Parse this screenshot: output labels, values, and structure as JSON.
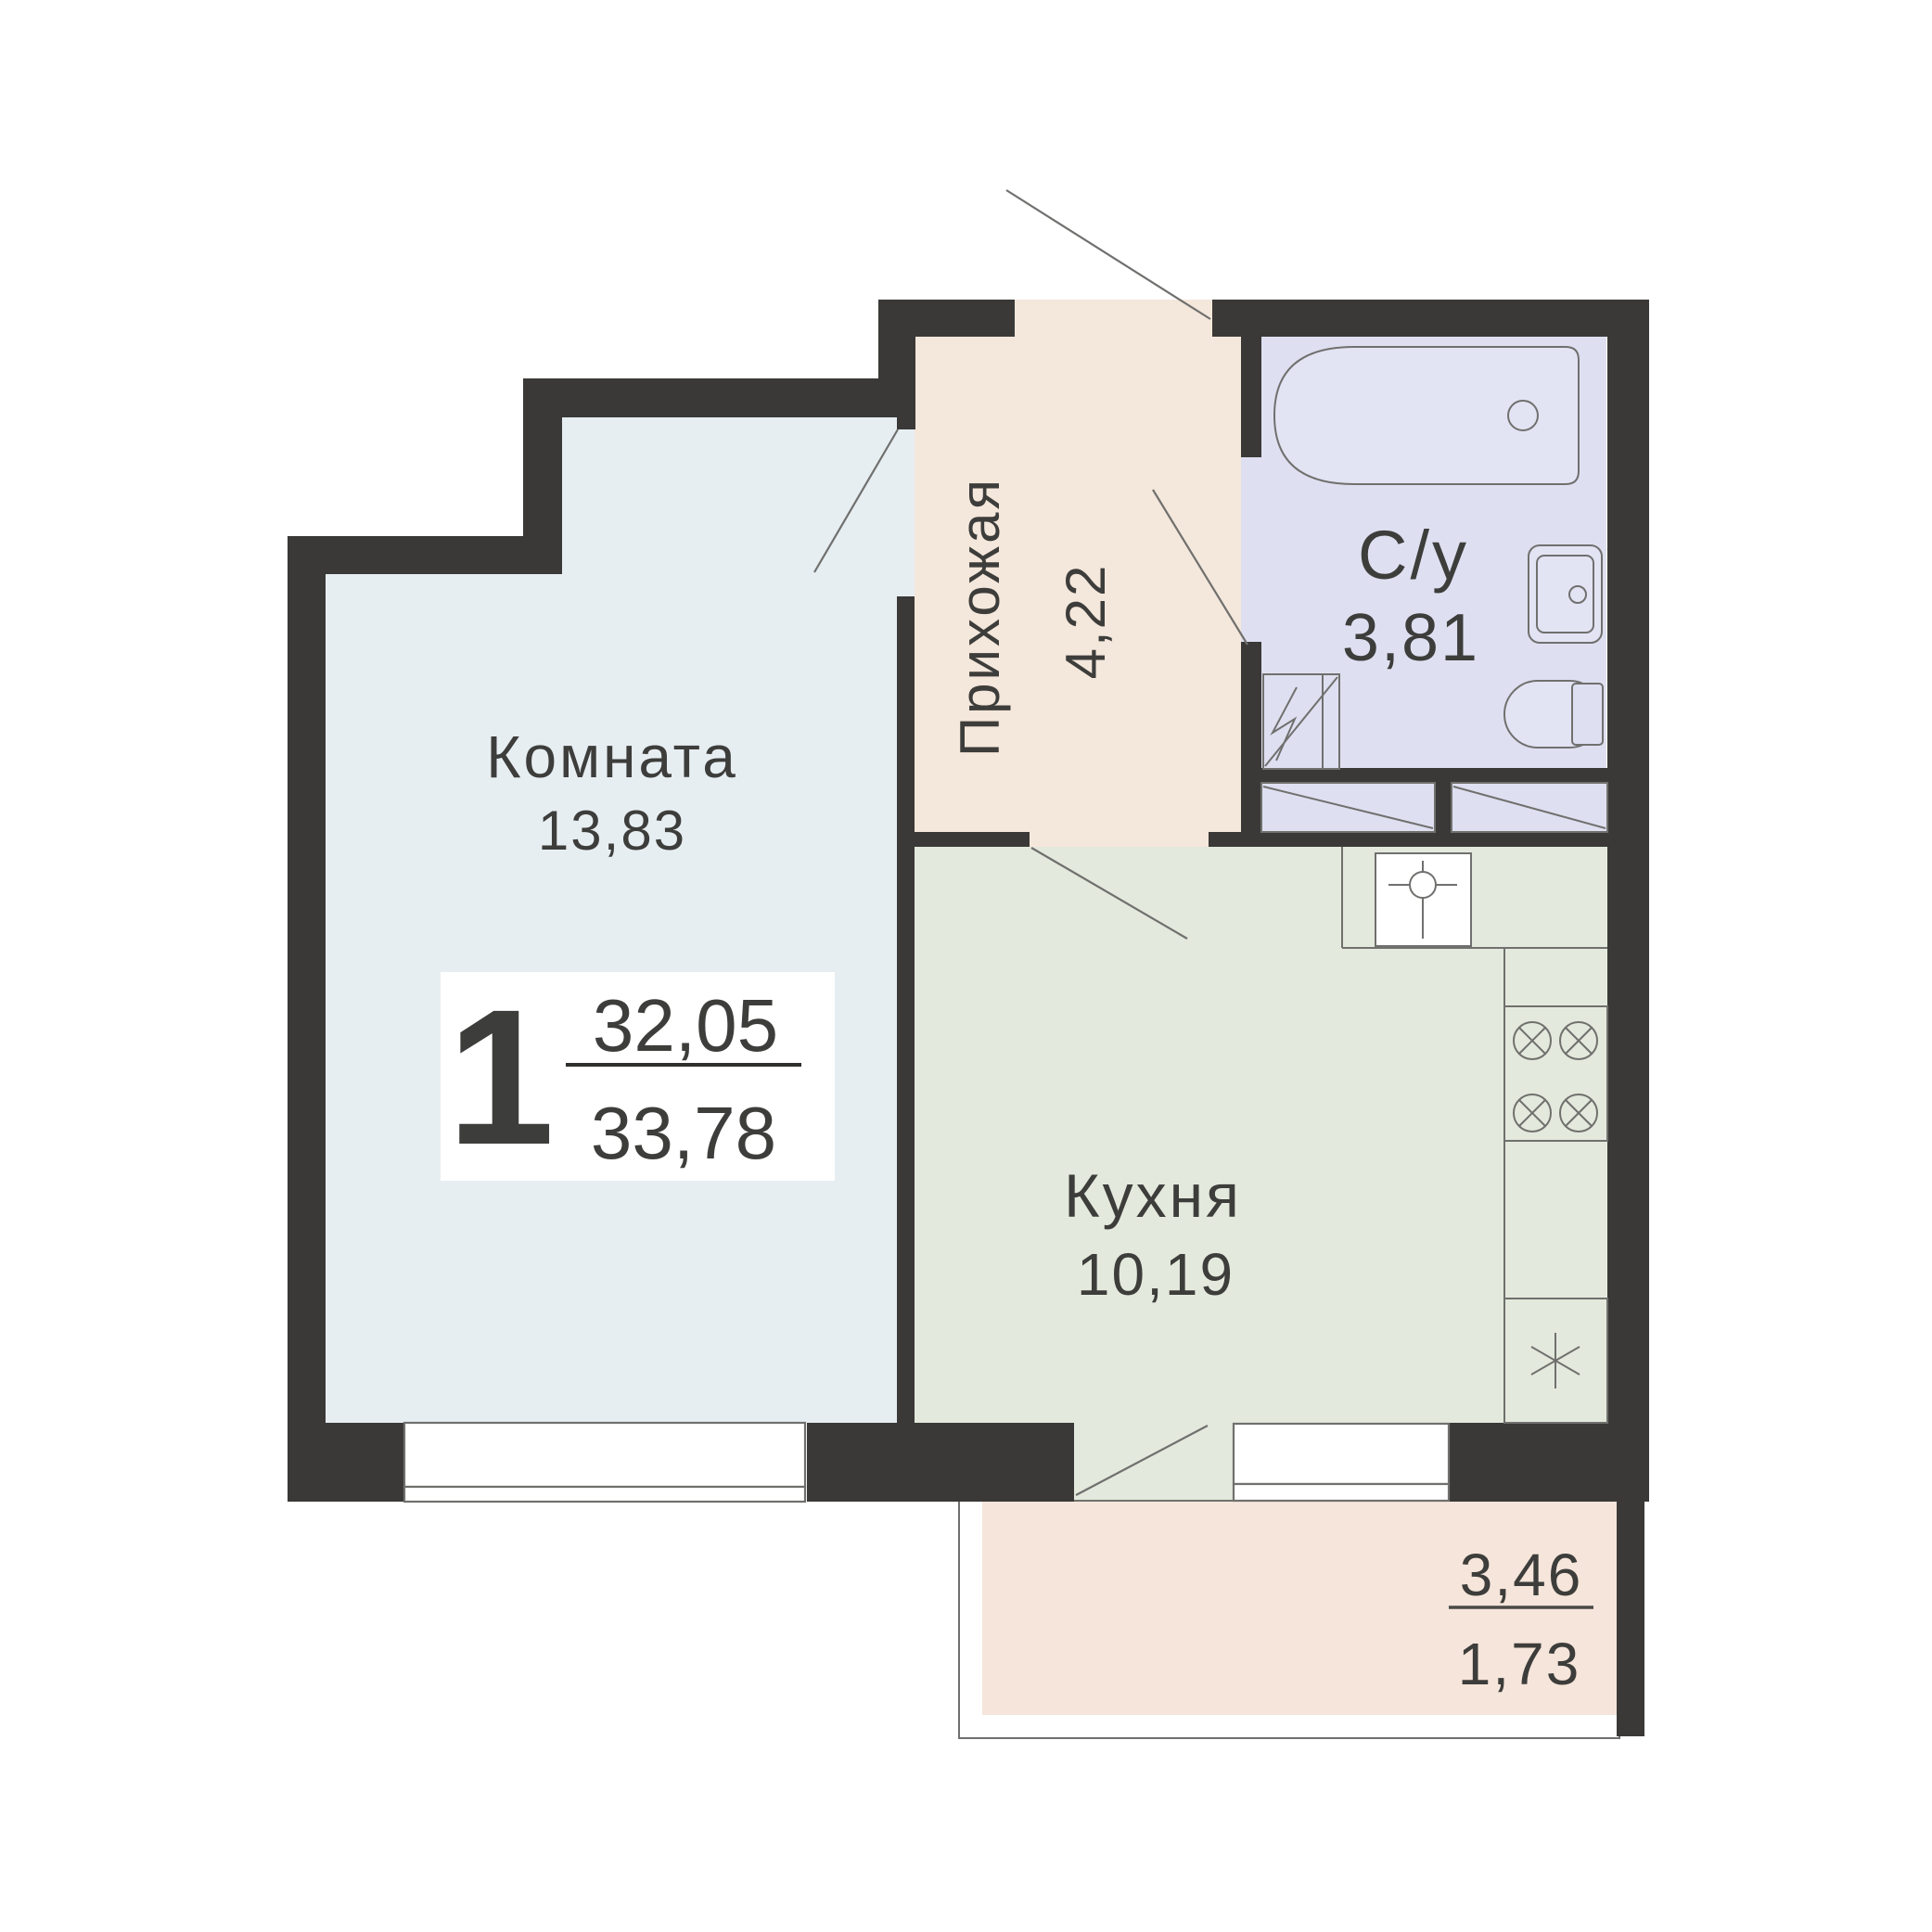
{
  "plan": {
    "unit_badge": {
      "rooms_count": "1",
      "living_area": "32,05",
      "total_area": "33,78"
    },
    "rooms": [
      {
        "name": "Комната",
        "area": "13,83"
      },
      {
        "name": "Прихожая",
        "area": "4,22"
      },
      {
        "name": "С/у",
        "area": "3,81"
      },
      {
        "name": "Кухня",
        "area": "10,19"
      }
    ],
    "balcony": {
      "area_full": "3,46",
      "area_reduced": "1,73"
    },
    "colors": {
      "wall": "#3a3937",
      "room_fill": "#e7eef2",
      "hallway_fill": "#f4e7db",
      "bathroom_fill": "#dee0f1",
      "fixture_fill": "#e2e4f4",
      "kitchen_fill": "#e3e9dc",
      "balcony_fill": "#f5e5da",
      "line": "#70706e",
      "text": "#3d3d3b"
    }
  }
}
